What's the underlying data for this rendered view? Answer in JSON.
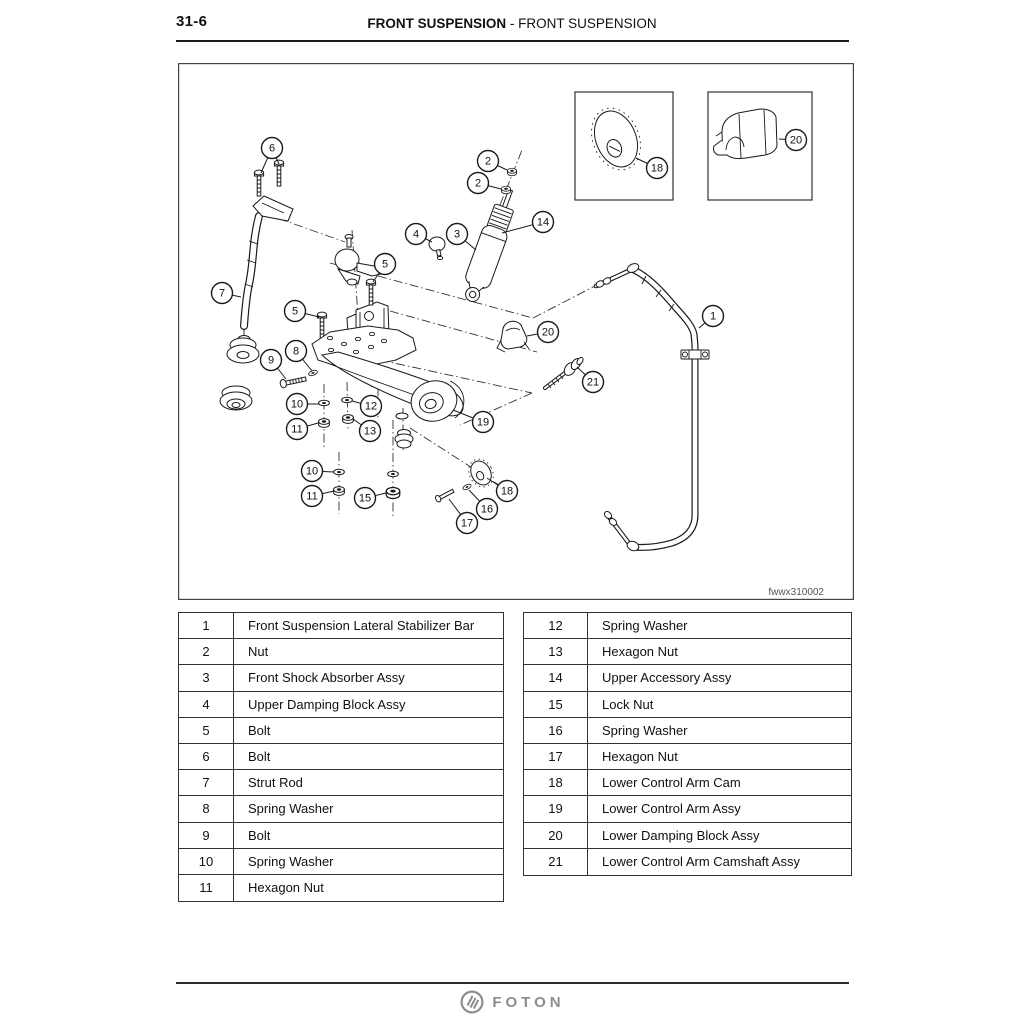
{
  "header": {
    "page_number": "31-6",
    "title_bold": "FRONT SUSPENSION",
    "title_regular": "- FRONT SUSPENSION"
  },
  "figure": {
    "caption": "fwwx310002",
    "callouts": [
      {
        "label": "6",
        "x": 272,
        "y": 148,
        "leaders": [
          [
            261,
            173
          ],
          [
            279,
            164
          ]
        ]
      },
      {
        "label": "2",
        "x": 488,
        "y": 161,
        "leaders": [
          [
            507,
            170
          ]
        ]
      },
      {
        "label": "2",
        "x": 478,
        "y": 183,
        "leaders": [
          [
            501,
            189
          ]
        ]
      },
      {
        "label": "4",
        "x": 416,
        "y": 234,
        "leaders": [
          [
            432,
            242
          ]
        ]
      },
      {
        "label": "3",
        "x": 457,
        "y": 234,
        "leaders": [
          [
            476,
            250
          ]
        ]
      },
      {
        "label": "14",
        "x": 543,
        "y": 222,
        "leaders": [
          [
            502,
            233
          ]
        ]
      },
      {
        "label": "5",
        "x": 385,
        "y": 264,
        "leaders": [
          [
            373,
            282
          ]
        ]
      },
      {
        "label": "7",
        "x": 222,
        "y": 293,
        "leaders": [
          [
            241,
            297
          ]
        ]
      },
      {
        "label": "5",
        "x": 295,
        "y": 311,
        "leaders": [
          [
            319,
            317
          ]
        ]
      },
      {
        "label": "8",
        "x": 296,
        "y": 351,
        "leaders": [
          [
            312,
            371
          ]
        ]
      },
      {
        "label": "9",
        "x": 271,
        "y": 360,
        "leaders": [
          [
            286,
            379
          ]
        ]
      },
      {
        "label": "20",
        "x": 548,
        "y": 332,
        "leaders": [
          [
            527,
            336
          ]
        ]
      },
      {
        "label": "1",
        "x": 713,
        "y": 316,
        "leaders": [
          [
            699,
            328
          ]
        ]
      },
      {
        "label": "21",
        "x": 593,
        "y": 382,
        "leaders": [
          [
            577,
            367
          ]
        ]
      },
      {
        "label": "10",
        "x": 297,
        "y": 404,
        "leaders": [
          [
            319,
            404
          ]
        ]
      },
      {
        "label": "12",
        "x": 371,
        "y": 406,
        "leaders": [
          [
            352,
            401
          ]
        ]
      },
      {
        "label": "11",
        "x": 297,
        "y": 429,
        "leaders": [
          [
            318,
            423
          ]
        ]
      },
      {
        "label": "13",
        "x": 370,
        "y": 431,
        "leaders": [
          [
            353,
            419
          ]
        ]
      },
      {
        "label": "19",
        "x": 483,
        "y": 422,
        "leaders": [
          [
            453,
            410
          ]
        ]
      },
      {
        "label": "10",
        "x": 312,
        "y": 471,
        "leaders": [
          [
            334,
            472
          ]
        ]
      },
      {
        "label": "11",
        "x": 312,
        "y": 496,
        "leaders": [
          [
            334,
            491
          ]
        ]
      },
      {
        "label": "15",
        "x": 365,
        "y": 498,
        "leaders": [
          [
            386,
            493
          ]
        ]
      },
      {
        "label": "18",
        "x": 507,
        "y": 491,
        "leaders": [
          [
            487,
            478
          ]
        ]
      },
      {
        "label": "16",
        "x": 487,
        "y": 509,
        "leaders": [
          [
            469,
            490
          ]
        ]
      },
      {
        "label": "17",
        "x": 467,
        "y": 523,
        "leaders": [
          [
            449,
            499
          ]
        ]
      },
      {
        "label": "18",
        "x": 657,
        "y": 168,
        "leaders": [
          [
            636,
            158
          ]
        ]
      },
      {
        "label": "20",
        "x": 796,
        "y": 140,
        "leaders": [
          [
            779,
            139
          ]
        ]
      }
    ]
  },
  "parts_left": {
    "rows": [
      {
        "no": "1",
        "name": "Front Suspension Lateral Stabilizer Bar"
      },
      {
        "no": "2",
        "name": "Nut"
      },
      {
        "no": "3",
        "name": "Front Shock Absorber Assy"
      },
      {
        "no": "4",
        "name": "Upper Damping Block Assy"
      },
      {
        "no": "5",
        "name": "Bolt"
      },
      {
        "no": "6",
        "name": "Bolt"
      },
      {
        "no": "7",
        "name": "Strut Rod"
      },
      {
        "no": "8",
        "name": "Spring Washer"
      },
      {
        "no": "9",
        "name": "Bolt"
      },
      {
        "no": "10",
        "name": "Spring Washer"
      },
      {
        "no": "11",
        "name": "Hexagon Nut"
      }
    ]
  },
  "parts_right": {
    "rows": [
      {
        "no": "12",
        "name": "Spring Washer"
      },
      {
        "no": "13",
        "name": "Hexagon Nut"
      },
      {
        "no": "14",
        "name": "Upper Accessory Assy"
      },
      {
        "no": "15",
        "name": "Lock Nut"
      },
      {
        "no": "16",
        "name": "Spring Washer"
      },
      {
        "no": "17",
        "name": "Hexagon Nut"
      },
      {
        "no": "18",
        "name": "Lower Control Arm Cam"
      },
      {
        "no": "19",
        "name": "Lower Control Arm Assy"
      },
      {
        "no": "20",
        "name": "Lower Damping Block Assy"
      },
      {
        "no": "21",
        "name": "Lower Control Arm Camshaft Assy"
      }
    ]
  },
  "footer": {
    "brand": "FOTON"
  }
}
